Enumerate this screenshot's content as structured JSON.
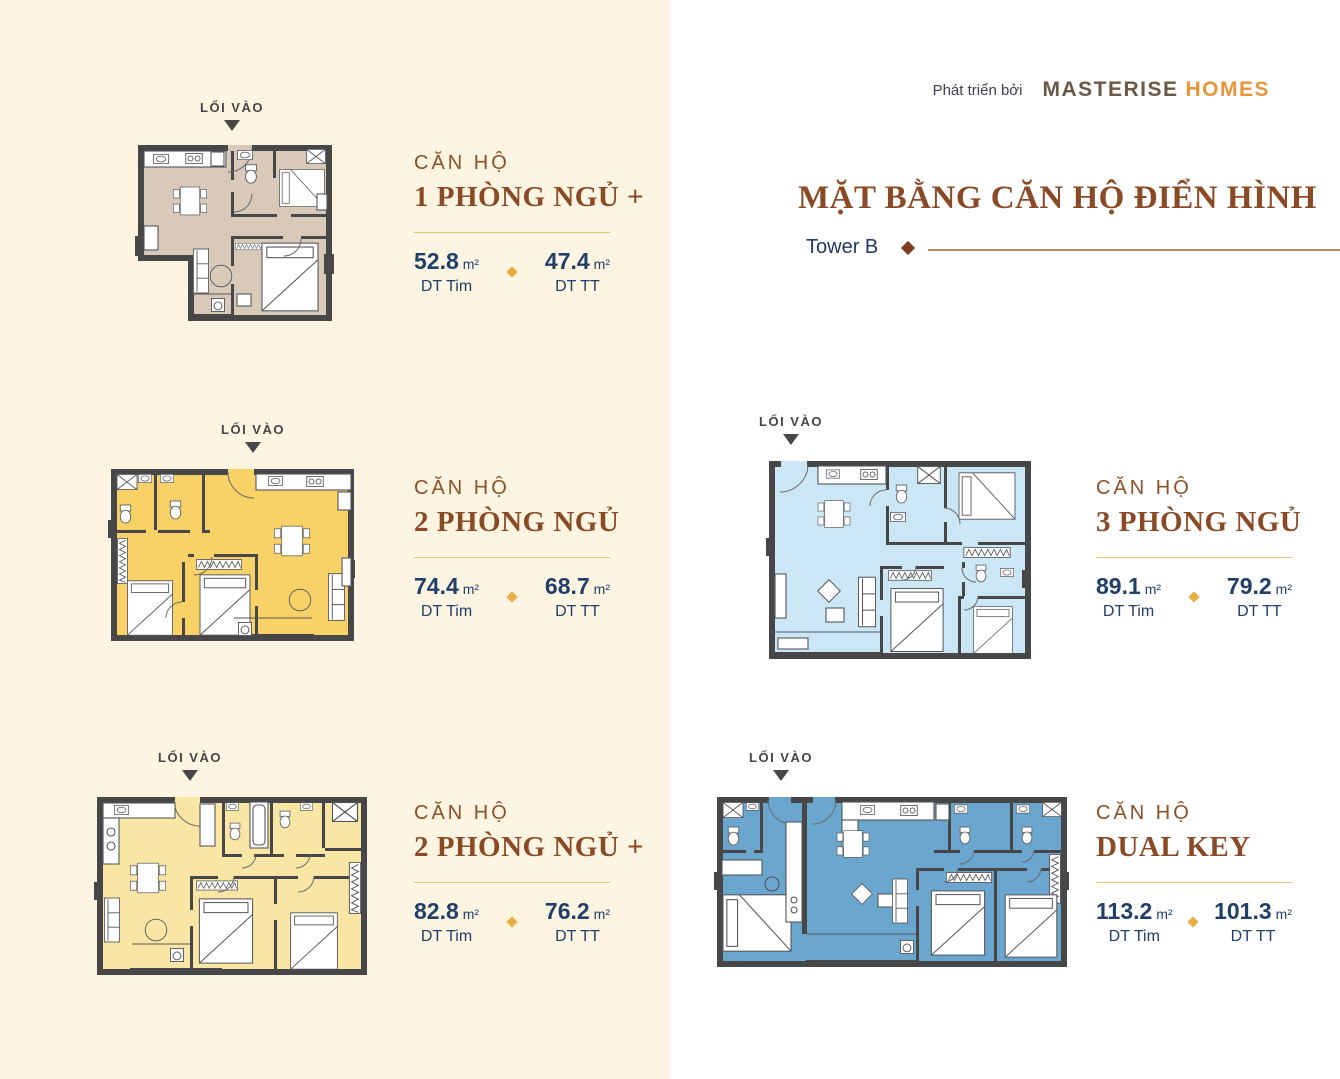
{
  "header": {
    "developer_prefix": "Phát triển bởi",
    "brand_primary": "MASTERISE",
    "brand_secondary": "HOMES",
    "title": "MẶT BẰNG CĂN HỘ ĐIỂN HÌNH",
    "subtitle": "Tower B"
  },
  "labels": {
    "unit_prefix": "CĂN HỘ",
    "entrance": "LỐI VÀO",
    "area_unit": "m²",
    "dt_tim": "DT Tim",
    "dt_tt": "DT TT"
  },
  "units": [
    {
      "id": "1pn-plus",
      "name": "1 PHÒNG NGỦ +",
      "area_tim": "52.8",
      "area_tt": "47.4",
      "color": "#d8c9b8"
    },
    {
      "id": "2pn",
      "name": "2 PHÒNG NGỦ",
      "area_tim": "74.4",
      "area_tt": "68.7",
      "color": "#f8d167"
    },
    {
      "id": "2pn-plus",
      "name": "2 PHÒNG NGỦ +",
      "area_tim": "82.8",
      "area_tt": "76.2",
      "color": "#f9e5a4"
    },
    {
      "id": "3pn",
      "name": "3 PHÒNG NGỦ",
      "area_tim": "89.1",
      "area_tt": "79.2",
      "color": "#cbe6f5"
    },
    {
      "id": "dual-key",
      "name": "DUAL KEY",
      "area_tim": "113.2",
      "area_tt": "101.3",
      "color": "#6ba6cf"
    }
  ],
  "colors": {
    "panel_background": "#fdf4e1",
    "accent_brown": "#8a4a26",
    "brand_brown": "#6b5846",
    "brand_orange": "#e8963c",
    "navy": "#214069",
    "gold_diamond": "#eaad43",
    "divider_gold": "#e3c27c",
    "subtitle_line": "#b18a64",
    "wall": "#474747"
  }
}
